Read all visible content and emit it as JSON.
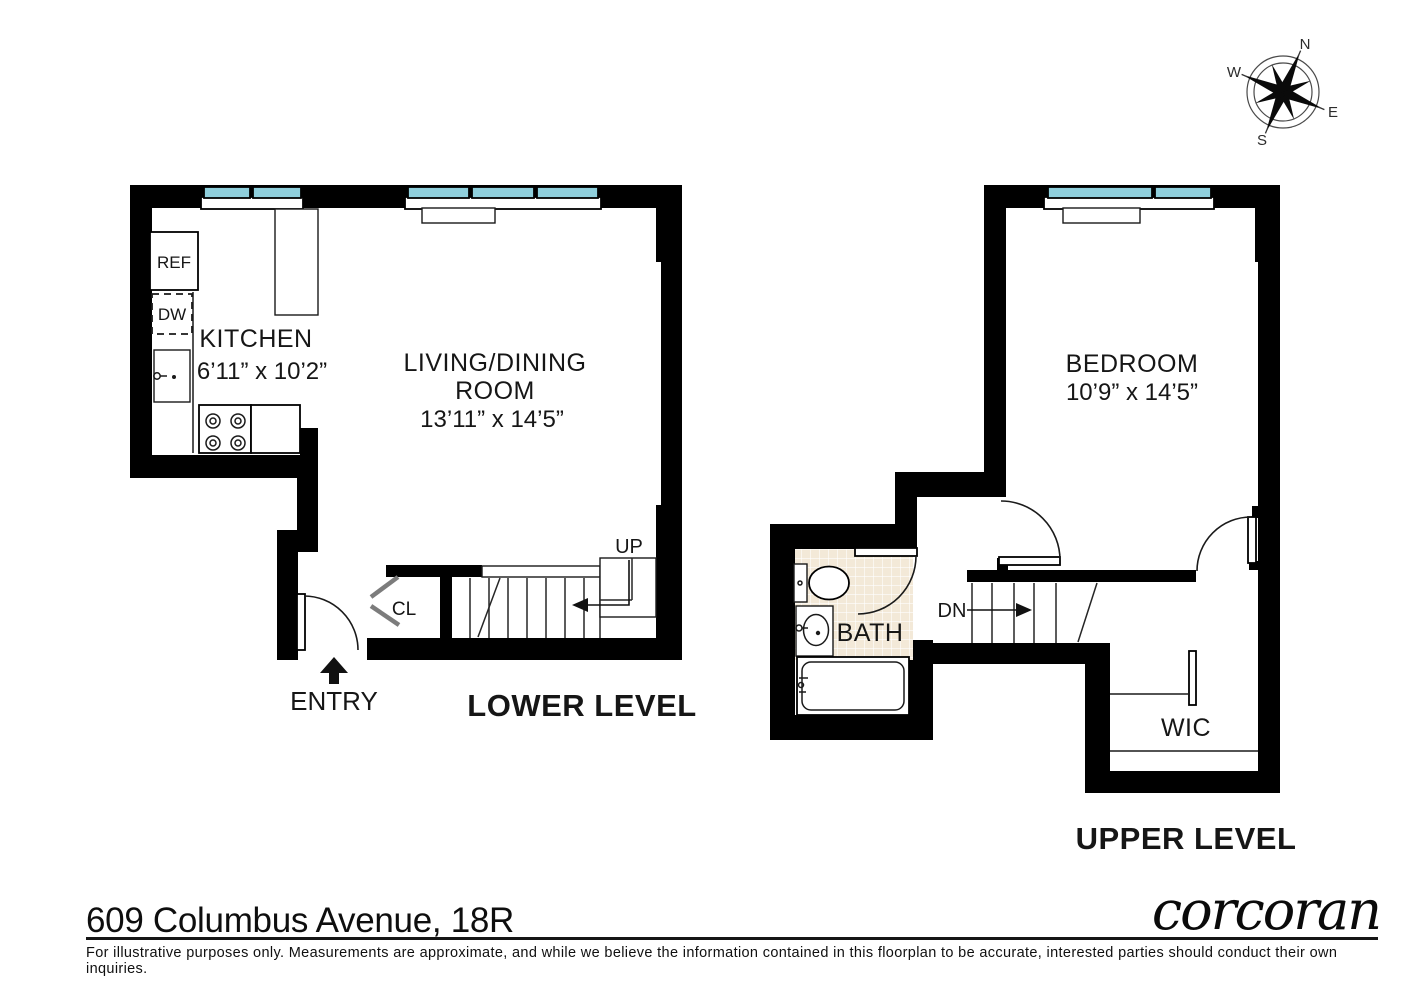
{
  "footer": {
    "address": "609 Columbus Avenue, 18R",
    "brand": "corcoran",
    "disclaimer": "For illustrative purposes only.  Measurements are approximate, and while we believe the information contained in this floorplan to be accurate, interested parties should conduct their own inquiries."
  },
  "compass": {
    "north": "N",
    "south": "S",
    "east": "E",
    "west": "W"
  },
  "lower_level": {
    "title": "LOWER LEVEL",
    "rooms": {
      "kitchen": {
        "name": "KITCHEN",
        "dims": "6’11” x 10’2”"
      },
      "living": {
        "name_line1": "LIVING/DINING",
        "name_line2": "ROOM",
        "dims": "13’11” x 14’5”"
      },
      "closet": "CL",
      "entry": "ENTRY"
    },
    "stairs": {
      "up": "UP"
    },
    "appliances": {
      "refrigerator": "REF",
      "dishwasher": "DW"
    }
  },
  "upper_level": {
    "title": "UPPER LEVEL",
    "rooms": {
      "bedroom": {
        "name": "BEDROOM",
        "dims": "10’9” x 14’5”"
      },
      "bath": "BATH",
      "wic": "WIC"
    },
    "stairs": {
      "down": "DN"
    }
  },
  "colors": {
    "wall": "#000000",
    "window_glass": "#8fcfdc",
    "bath_tile": "#f3e9d8",
    "paper": "#ffffff"
  }
}
